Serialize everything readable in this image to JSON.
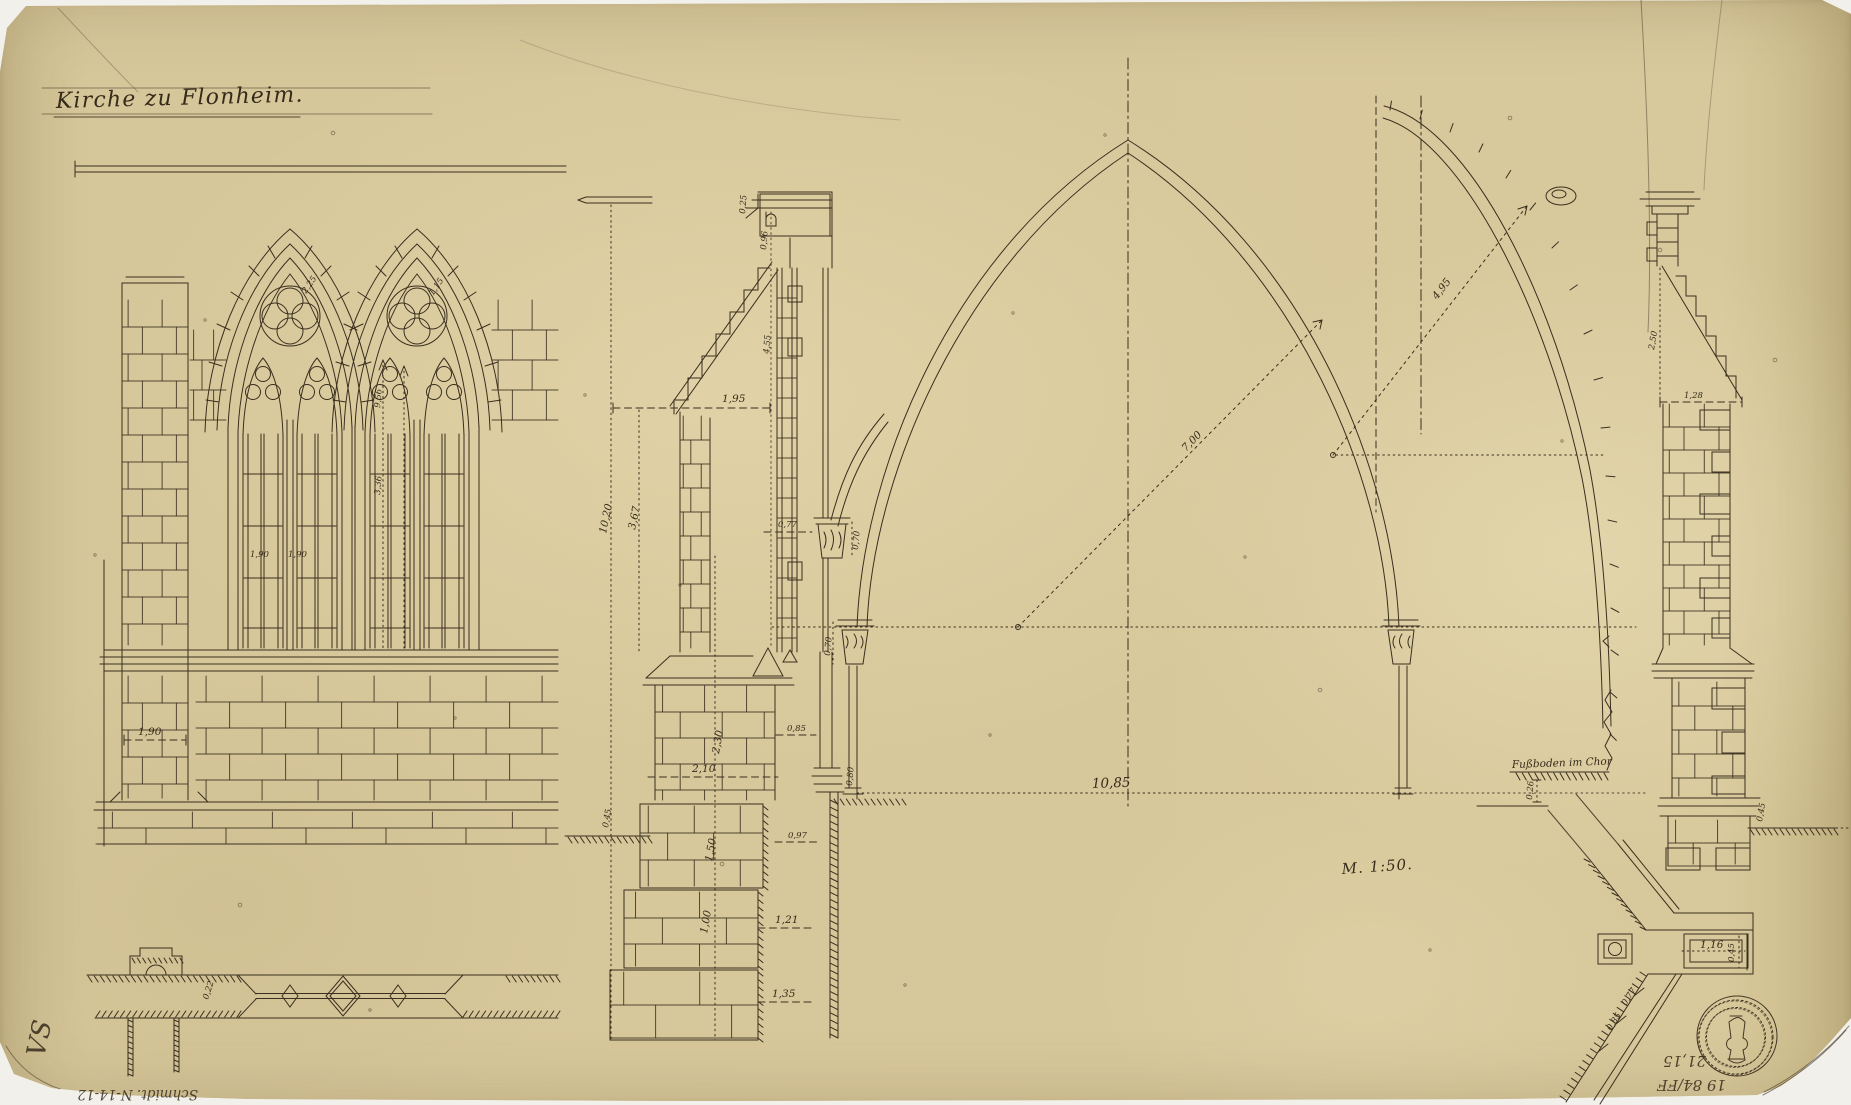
{
  "sheet": {
    "title": "Kirche zu Flonheim.",
    "scale_note": "M. 1:50.",
    "floor_label": "Fußboden im Chor"
  },
  "palette": {
    "paper": "#d5c698",
    "ink": "#3a2f1e",
    "pencil": "#8e8472",
    "seal": "#c6b990"
  },
  "dims": {
    "elevation": {
      "buttress_width": "1,90",
      "light_left": "1,90",
      "light_right": "1,90",
      "arch_tip_left": "2,25",
      "arch_tip_right": "1,15",
      "shaft_upper": "9,56",
      "shaft_lower": "3,36"
    },
    "window_plan": {
      "jamb_depth": "0,22"
    },
    "section": {
      "cornice_lip": "0,25",
      "frieze_height": "0,96",
      "window_height": "4,55",
      "coping_width": "1,95",
      "total_height": "10,20",
      "upper_height": "3,67",
      "jam_width": "0,77",
      "capital_height": "0,70",
      "mid_height": "2,30",
      "mid_width": "2,10",
      "wall_offset": "0,85",
      "wall_width": "0,97",
      "base_height": "1,50",
      "footing_height": "1,00",
      "footing_width": "1,21",
      "foundation_width": "1,35",
      "plinth_height": "0,80",
      "ground_depth": "0,45"
    },
    "arch": {
      "radius_nave": "7,00",
      "radius_choir": "4,95",
      "span": "10,85",
      "capital_height": "0,70"
    },
    "choir": {
      "floor_step": "0,26"
    },
    "right_buttress": {
      "weathering_height": "2,50",
      "weathering_width": "1,28",
      "plinth_depth": "0,45"
    },
    "corner_plan": {
      "recess_width": "1,16",
      "recess_depth": "0,45",
      "wall_a": "0,77",
      "wall_b": "0,85"
    }
  },
  "pencil": {
    "corner_mark": "VS",
    "inventory_note": "Schmidt. N-14-12",
    "archive_line_1": "19 84/FF",
    "archive_line_2": "21,15"
  }
}
